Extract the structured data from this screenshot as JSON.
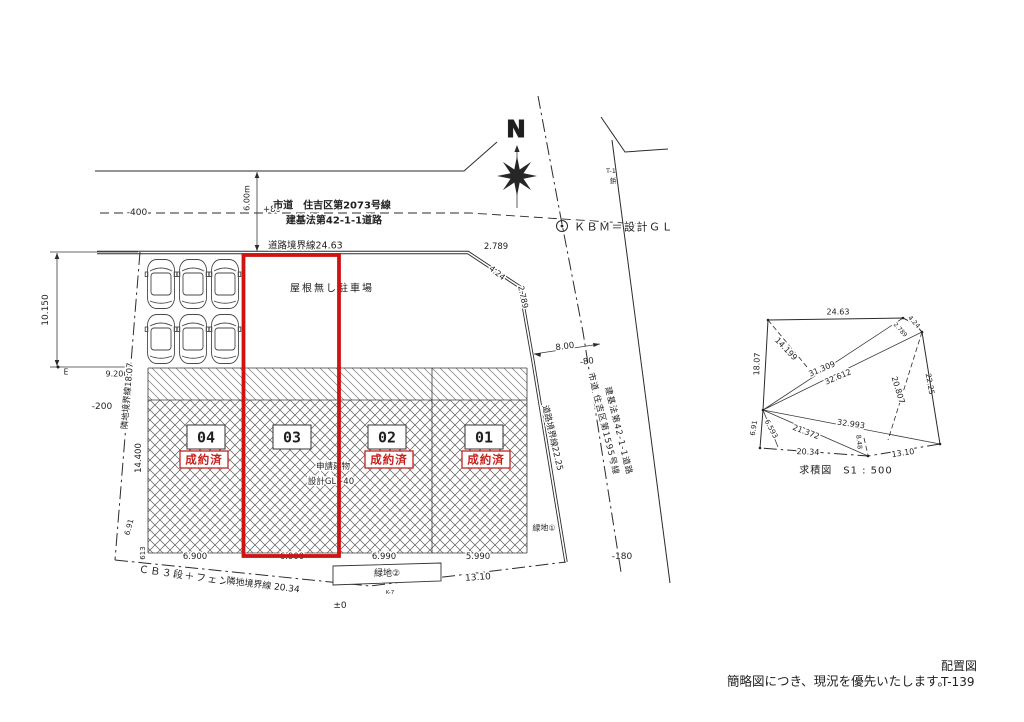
{
  "colors": {
    "highlight_red": "#cf1212",
    "line": "#2b2b2b",
    "status_red": "#c4231f"
  },
  "compass": {
    "north": "N"
  },
  "top_road": {
    "elev_left": "-400",
    "width": "6.00m",
    "elev": "+80",
    "name1": "市道　住吉区第2073号線",
    "name2": "建基法第42-1-1道路",
    "boundary": "道路境界線24.63",
    "bend_h": "2.789",
    "bend_diag": "4.24",
    "bend_v": "2.789"
  },
  "benchmark": {
    "kbm": "ＫＢＭ＝設計ＧＬ",
    "t1": "T-1",
    "pin": "鋲"
  },
  "east_road": {
    "name1": "市道 住吉区第1595号線",
    "name2": "建基法第42-1-1道路",
    "boundary": "道路境界線22.25",
    "dim": "8.00",
    "elev_upper": "-80",
    "elev_lower": "-180"
  },
  "west": {
    "parking_depth": "10.150",
    "bench_mark": "E",
    "boundary": "隣地境界線18.07",
    "elev": "-200",
    "offset": "9.200",
    "lot_depth": "14.400",
    "corner_offset": "613",
    "edge": "6.91"
  },
  "parking": {
    "label": "屋根無し駐車場"
  },
  "lots": [
    {
      "no": "04",
      "status": "成約済",
      "width": "6.900"
    },
    {
      "no": "03",
      "status": "",
      "width": "6.900"
    },
    {
      "no": "02",
      "status": "成約済",
      "width": "6.990"
    },
    {
      "no": "01",
      "status": "成約済",
      "width": "5.990"
    }
  ],
  "lot3_note": {
    "line1": "申請建物",
    "line2": "設計GL+40"
  },
  "south": {
    "fence": "ＣＢ３段＋フェンス",
    "boundary": "隣地境界線 20.34",
    "green2": "緑地②",
    "green1": "緑地①",
    "dim": "13.10",
    "level": "±0",
    "k7": "K-7"
  },
  "survey": {
    "title": "求積図　S1 : 500",
    "top": "24.63",
    "left": "18.07",
    "right": "22.25",
    "bottom_left": "20.34",
    "bottom_right": "13.10",
    "left_lower": "6.91",
    "h1": "14.199",
    "d1": "31.309",
    "d2": "32.612",
    "d3": "20.807",
    "d4": "32.993",
    "d5": "21.372",
    "d6": "6.593",
    "h2": "8.48",
    "jog1": "2.789",
    "jog2": "4.24"
  },
  "footer": {
    "disclaimer": "簡略図につき、現況を優先いたします。",
    "sheet": "配置図",
    "number": "T-139"
  }
}
